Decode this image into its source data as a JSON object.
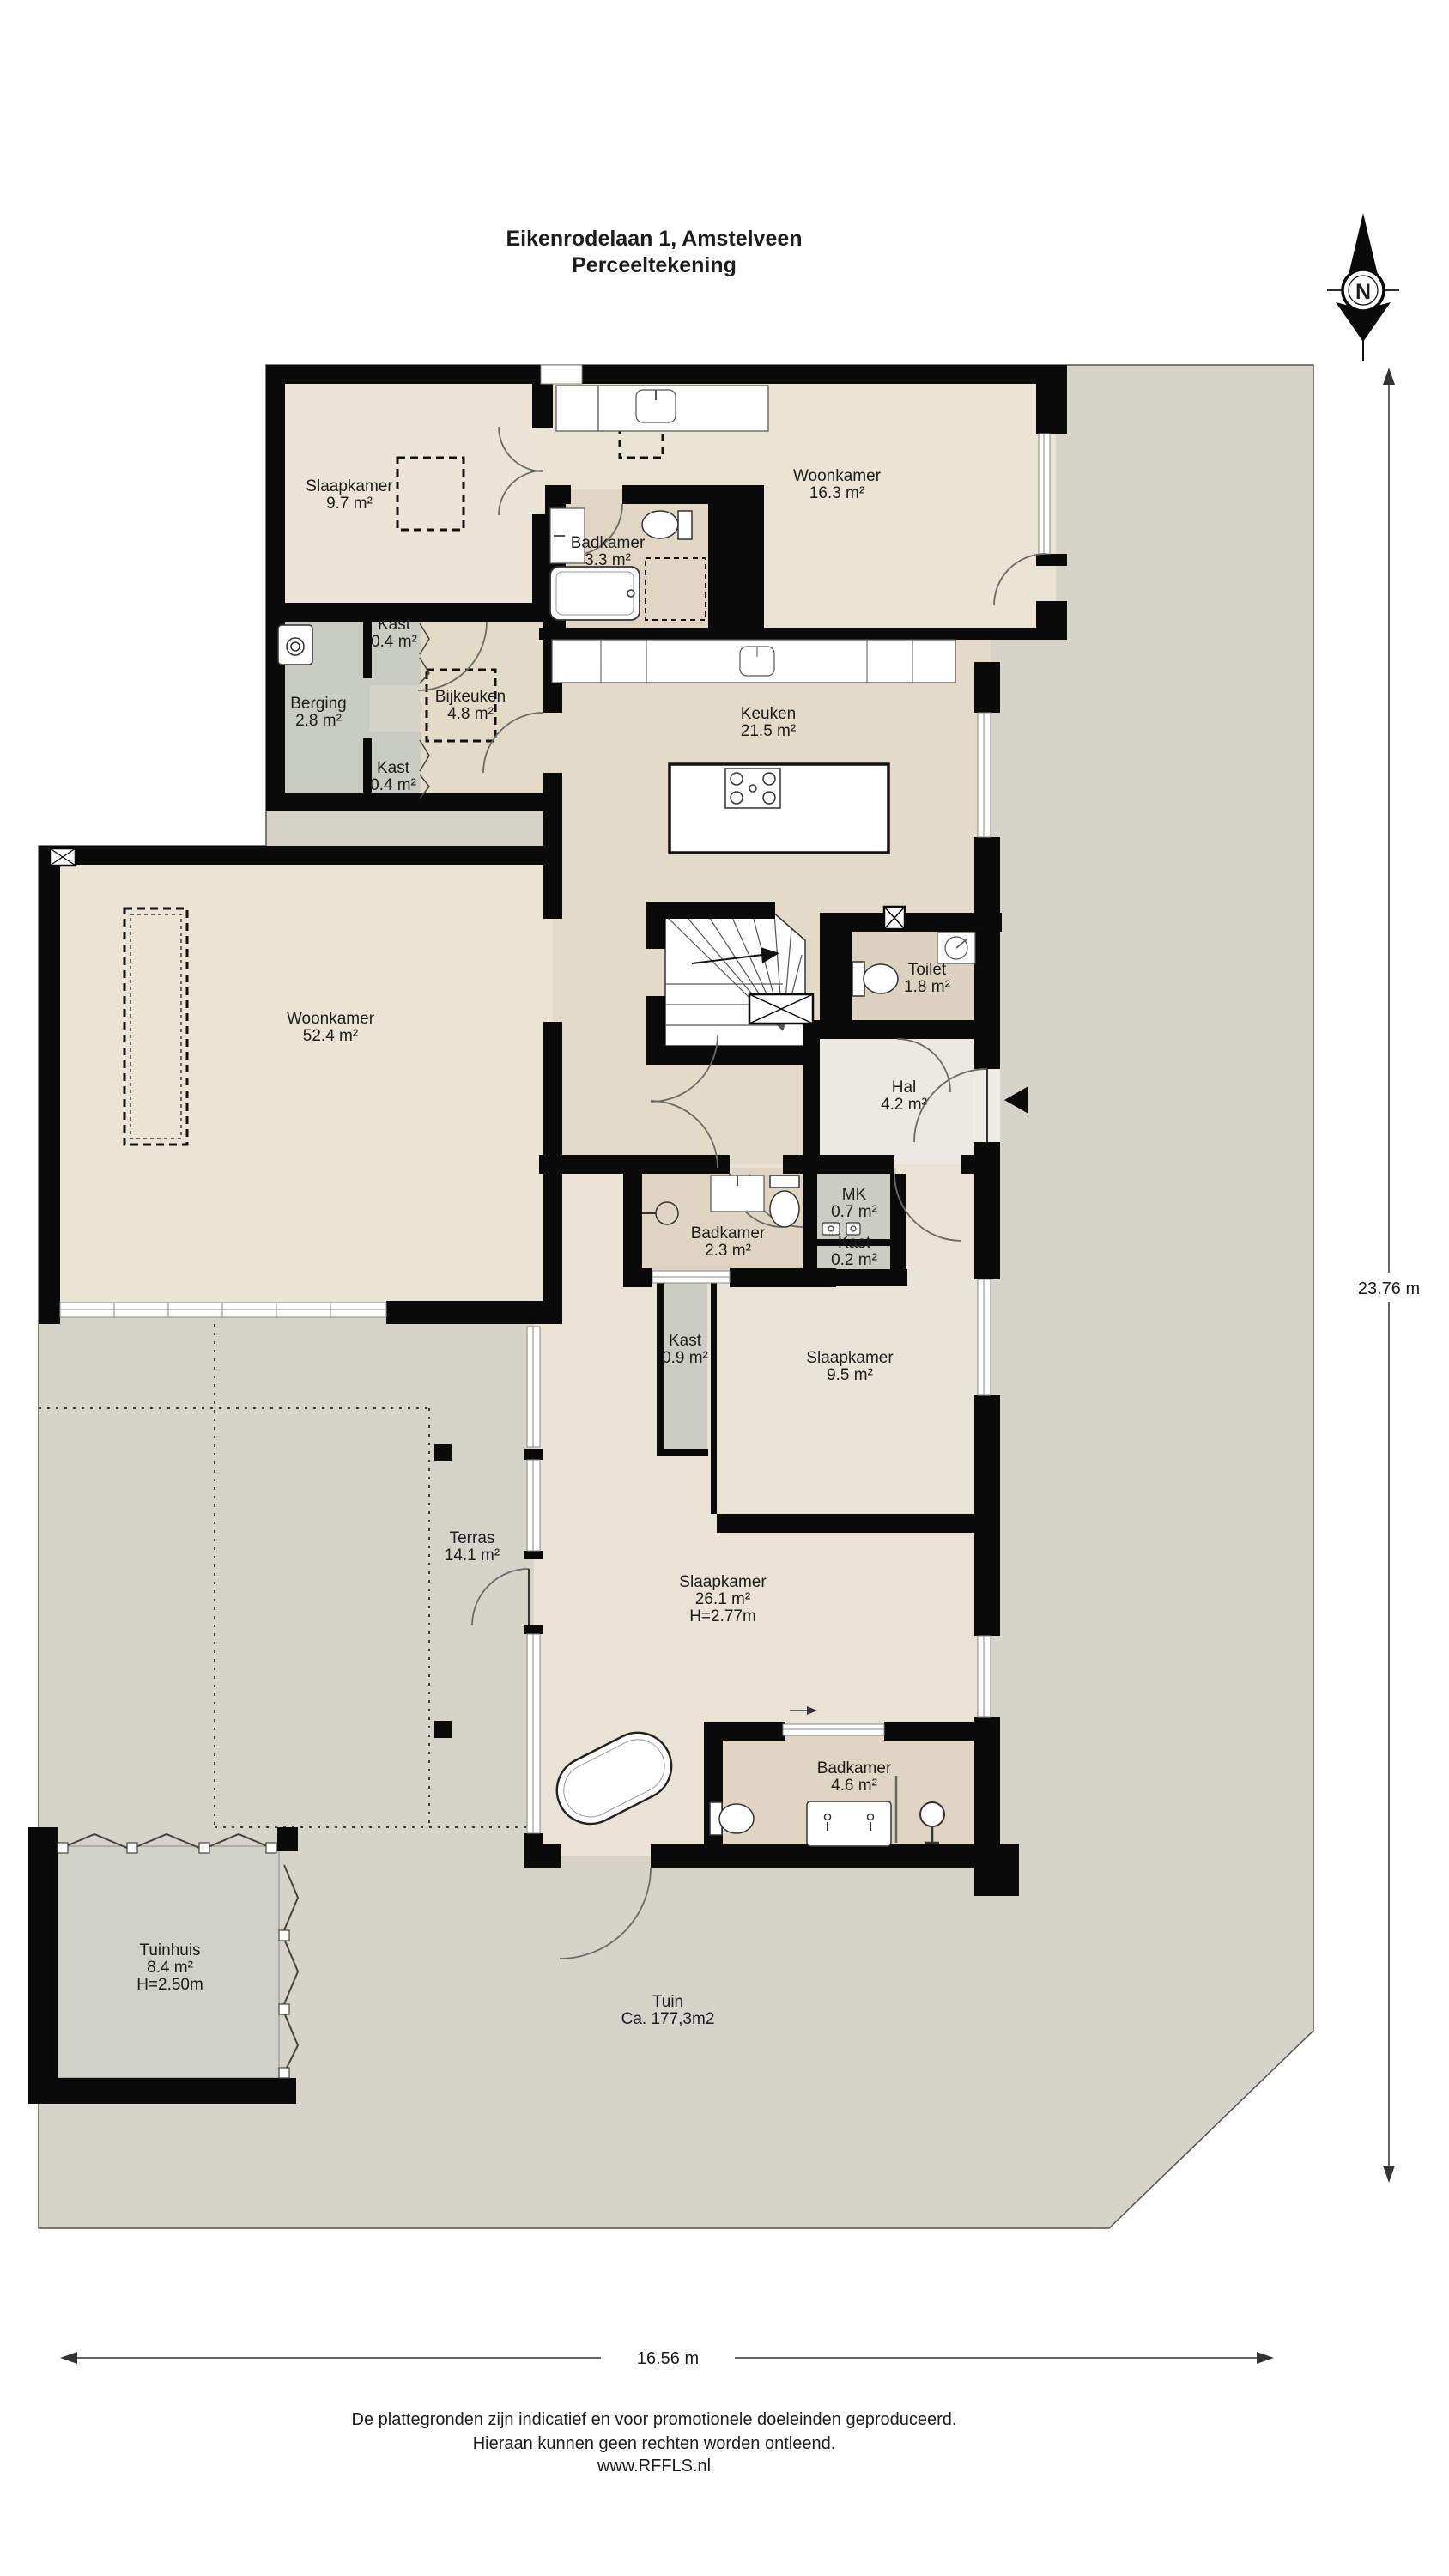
{
  "title": {
    "line1": "Eikenrodelaan 1, Amstelveen",
    "line2": "Perceeltekening"
  },
  "compass": {
    "north_label": "N"
  },
  "dimensions": {
    "vertical": "23.76 m",
    "horizontal": "16.56 m"
  },
  "rooms": [
    {
      "id": "slaapkamer-1",
      "name": "Slaapkamer",
      "area": "9.7 m²"
    },
    {
      "id": "woonkamer-boven",
      "name": "Woonkamer",
      "area": "16.3 m²"
    },
    {
      "id": "badkamer-1",
      "name": "Badkamer",
      "area": "3.3 m²"
    },
    {
      "id": "kast-1",
      "name": "Kast",
      "area": "0.4 m²"
    },
    {
      "id": "berging",
      "name": "Berging",
      "area": "2.8 m²"
    },
    {
      "id": "bijkeuken",
      "name": "Bijkeuken",
      "area": "4.8 m²"
    },
    {
      "id": "kast-2",
      "name": "Kast",
      "area": "0.4 m²"
    },
    {
      "id": "keuken",
      "name": "Keuken",
      "area": "21.5 m²"
    },
    {
      "id": "toilet",
      "name": "Toilet",
      "area": "1.8 m²"
    },
    {
      "id": "hal",
      "name": "Hal",
      "area": "4.2 m²"
    },
    {
      "id": "woonkamer",
      "name": "Woonkamer",
      "area": "52.4 m²"
    },
    {
      "id": "badkamer-2",
      "name": "Badkamer",
      "area": "2.3 m²"
    },
    {
      "id": "mk",
      "name": "MK",
      "area": "0.7 m²"
    },
    {
      "id": "kast-3",
      "name": "Kast",
      "area": "0.2 m²"
    },
    {
      "id": "kast-4",
      "name": "Kast",
      "area": "0.9 m²"
    },
    {
      "id": "slaapkamer-2",
      "name": "Slaapkamer",
      "area": "9.5 m²"
    },
    {
      "id": "terras",
      "name": "Terras",
      "area": "14.1 m²"
    },
    {
      "id": "slaapkamer-3",
      "name": "Slaapkamer",
      "area": "26.1 m²",
      "height": "H=2.77m"
    },
    {
      "id": "badkamer-3",
      "name": "Badkamer",
      "area": "4.6 m²"
    },
    {
      "id": "tuinhuis",
      "name": "Tuinhuis",
      "area": "8.4 m²",
      "height": "H=2.50m"
    },
    {
      "id": "tuin",
      "name": "Tuin",
      "area": "Ca. 177,3m2"
    }
  ],
  "footer": {
    "line1": "De plattegronden zijn indicatief en voor promotionele doeleinden geproduceerd.",
    "line2": "Hieraan kunnen geen rechten worden ontleend.",
    "line3": "www.RFFLS.nl"
  },
  "colors": {
    "wall": "#0a0a0a",
    "parcel": "#d6d3c9",
    "floor_beige": "#ebe3d4",
    "floor_tan": "#e2d7c5",
    "floor_gray": "#c9ccc3",
    "floor_light": "#ebe9e1"
  }
}
